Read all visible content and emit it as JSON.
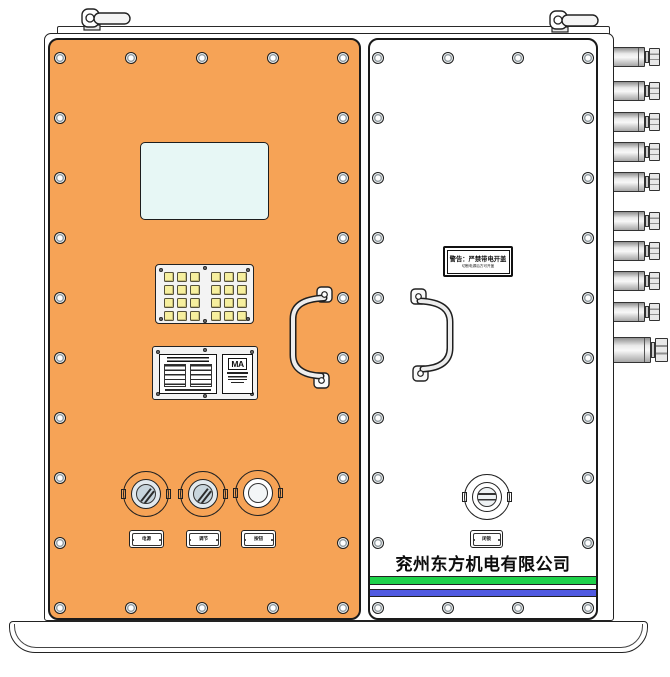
{
  "device": {
    "company_name": "兖州东方机电有限公司",
    "ma_mark": "MA",
    "warning_label": {
      "line1": "警告：严禁带电开盖",
      "line2": "切断电源后方可开盖"
    },
    "left_panel": {
      "knob_labels": [
        "电源",
        "调节",
        "按钮"
      ],
      "keypad_keys": 24
    },
    "right_panel": {
      "lock_label": "闭锁"
    },
    "cable_glands_count": 10,
    "colors": {
      "door_orange": "#F6A356",
      "screen_cyan": "#E7F7F5",
      "key_yellow": "#F6EF9E",
      "stripe_green": "#1ED24A",
      "stripe_blue": "#505AE1"
    }
  }
}
